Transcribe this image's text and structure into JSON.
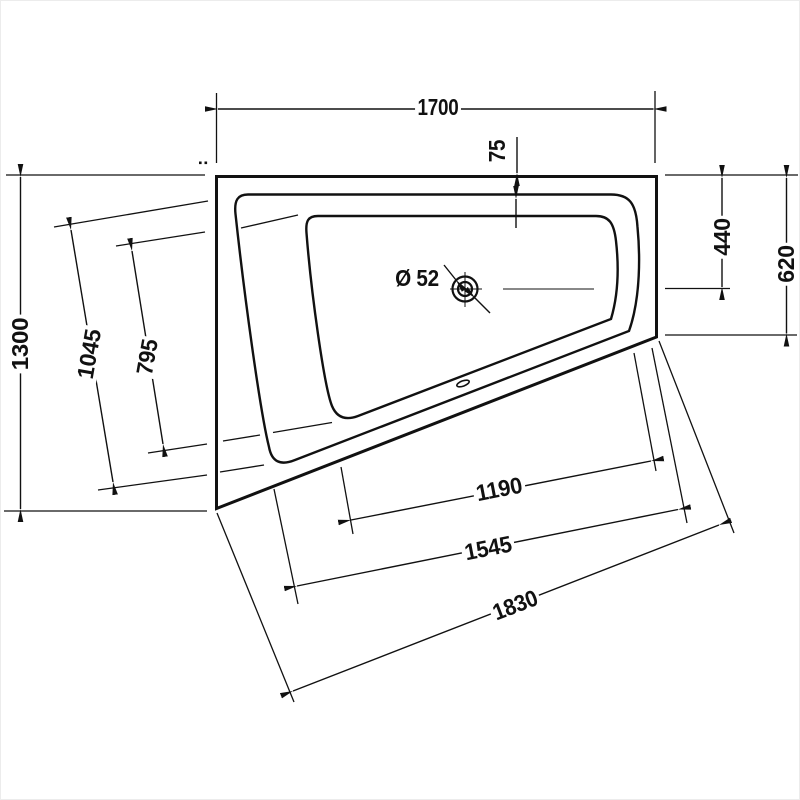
{
  "drawing": {
    "type": "bathtub corner model - plan view technical dimension drawing",
    "unit": "mm",
    "background": "#ffffff",
    "line_color": "#111111",
    "labels": {
      "width_top": "1700",
      "rim_offset_top": "75",
      "top_to_drain": "440",
      "right_side_depth": "620",
      "left_side_height": "1300",
      "rim_opening_width": "1045",
      "basin_opening_width": "795",
      "drain_diameter": "Ø 52",
      "bottom_basin_length": "1190",
      "bottom_rim_length": "1545",
      "bottom_outer_length": "1830"
    }
  }
}
